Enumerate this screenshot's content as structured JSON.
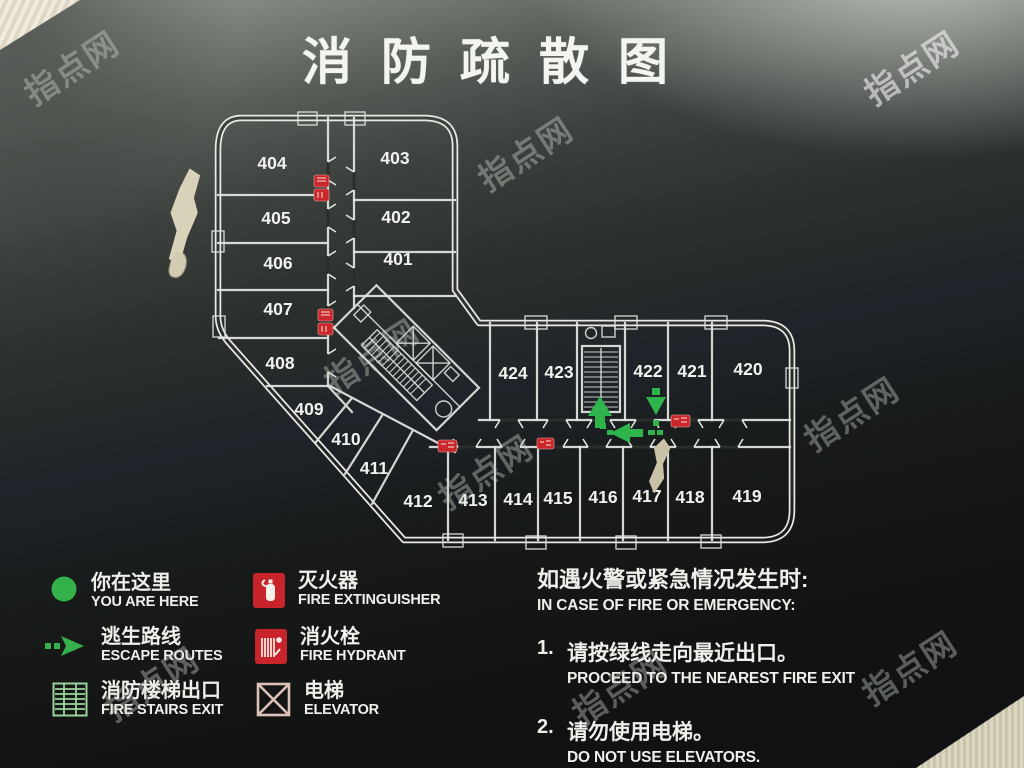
{
  "title": "消防疏散图",
  "floor_plan": {
    "room_numbers": [
      "401",
      "402",
      "403",
      "404",
      "405",
      "406",
      "407",
      "408",
      "409",
      "410",
      "411",
      "412",
      "413",
      "414",
      "415",
      "416",
      "417",
      "418",
      "419",
      "420",
      "421",
      "422",
      "423",
      "424"
    ]
  },
  "legend": {
    "items": [
      {
        "zh": "你在这里",
        "en": "YOU ARE HERE",
        "icon": "you-are-here-dot"
      },
      {
        "zh": "逃生路线",
        "en": "ESCAPE ROUTES",
        "icon": "escape-route-arrow"
      },
      {
        "zh": "消防楼梯出口",
        "en": "FIRE STAIRS EXIT",
        "icon": "fire-stairs"
      },
      {
        "zh": "灭火器",
        "en": "FIRE EXTINGUISHER",
        "icon": "fire-extinguisher"
      },
      {
        "zh": "消火栓",
        "en": "FIRE HYDRANT",
        "icon": "fire-hydrant"
      },
      {
        "zh": "电梯",
        "en": "ELEVATOR",
        "icon": "elevator-crossed"
      }
    ]
  },
  "instructions": {
    "heading_zh": "如遇火警或紧急情况发生时:",
    "heading_en": "IN CASE OF FIRE OR EMERGENCY:",
    "steps": [
      {
        "num": "1.",
        "zh": "请按绿线走向最近出口。",
        "en": "PROCEED TO THE NEAREST FIRE EXIT"
      },
      {
        "num": "2.",
        "zh": "请勿使用电梯。",
        "en": "DO NOT USE ELEVATORS."
      }
    ]
  },
  "watermark": {
    "text": "指点网"
  },
  "colors": {
    "route_green": "#2fb44b",
    "stairs_green": "#9cd39c",
    "equipment_red": "#c9272b",
    "plan_line_white": "#e7eae5",
    "board_dark": "#14161a"
  }
}
